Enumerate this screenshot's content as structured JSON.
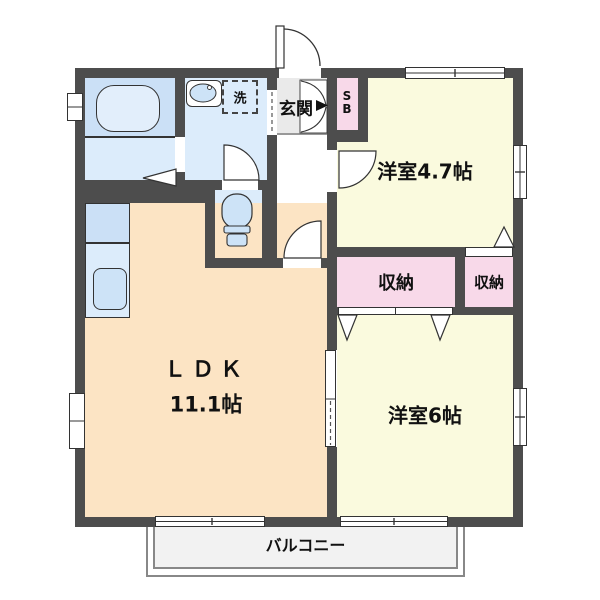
{
  "plan": {
    "entrance": {
      "label": "玄関"
    },
    "shoe_box": {
      "label": "SB"
    },
    "washroom": {
      "washing_machine_label": "洗"
    },
    "room_47": {
      "label": "洋室4.7帖"
    },
    "room_6": {
      "label": "洋室6帖"
    },
    "ldk": {
      "label": "ＬＤＫ",
      "size": "11.1帖"
    },
    "closet_main": {
      "label": "収納"
    },
    "closet_sub": {
      "label": "収納"
    },
    "balcony": {
      "label": "バルコニー"
    }
  },
  "colors": {
    "wall": "#4d4d4d",
    "ldk_floor": "#fce4c4",
    "western_room_floor": "#fafade",
    "closet_floor": "#f8d9e9",
    "wet_area_floor": "#dcecfb",
    "bath_floor": "#cbe0f6",
    "fixture_blue": "#cde3f7",
    "entrance_floor": "#eaeaea",
    "hallway_floor": "#ffffff",
    "balcony_floor": "#f2f2f2"
  }
}
